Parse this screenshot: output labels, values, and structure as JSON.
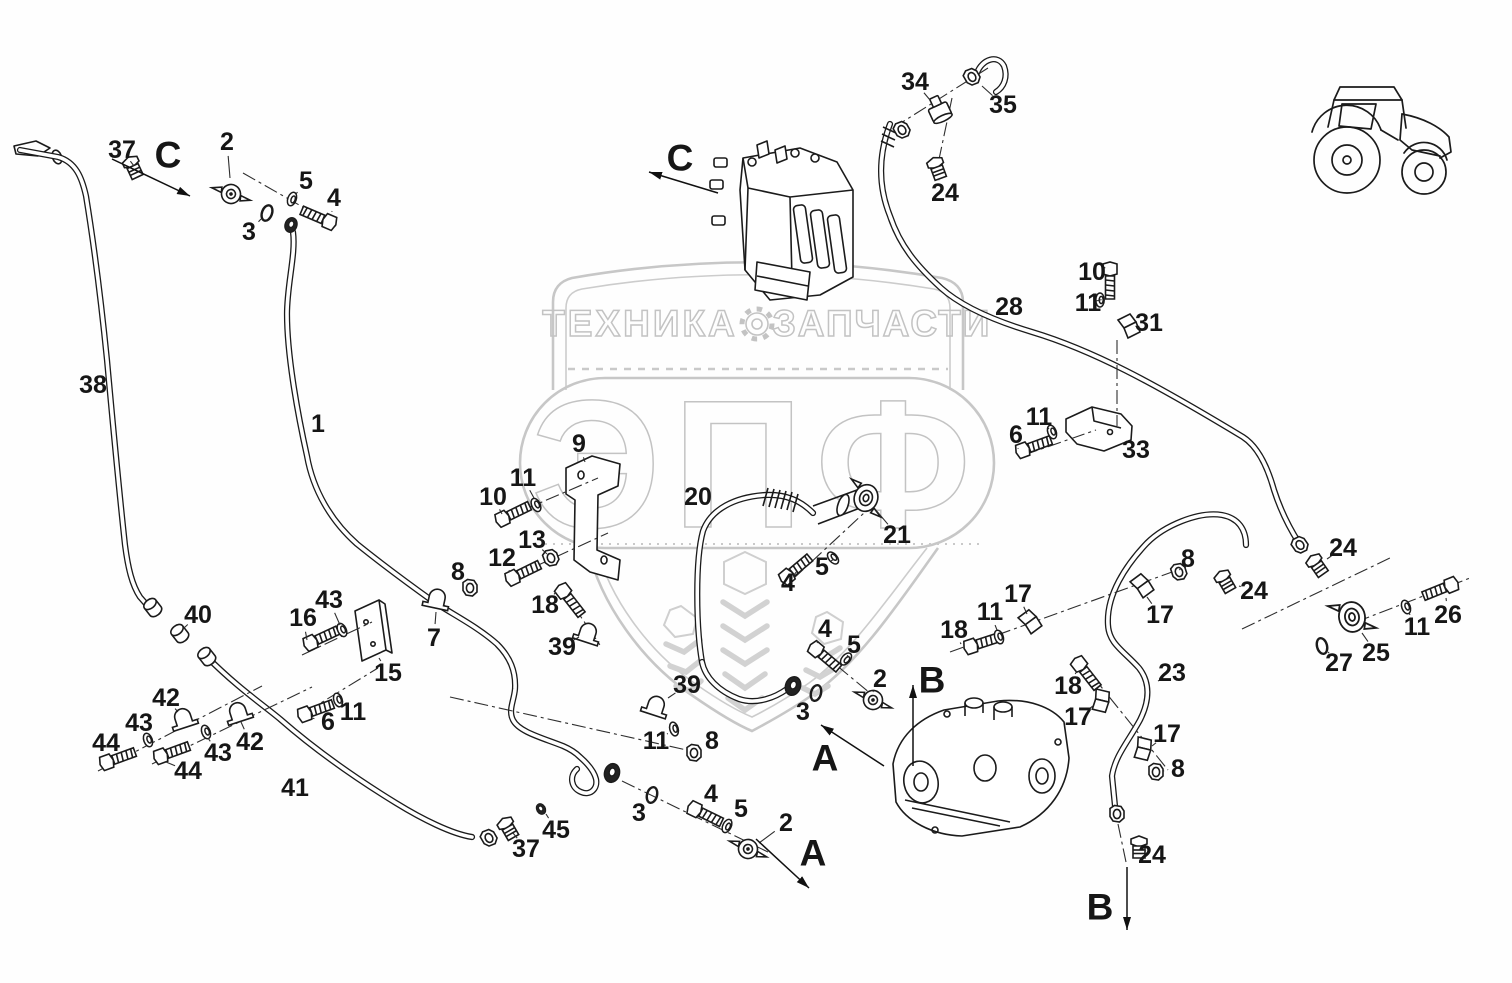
{
  "watermark": {
    "top_left": "ТЕХНИКА",
    "top_right": "ЗАПЧАСТИ",
    "big": "ЭПФ",
    "color": "#c7c7c7"
  },
  "colors": {
    "line": "#1b1b1b",
    "label": "#161616",
    "watermark": "#c7c7c7"
  },
  "callouts": [
    {
      "n": "37",
      "x": 122,
      "y": 150,
      "tx": 134,
      "ty": 166
    },
    {
      "n": "2",
      "x": 227,
      "y": 142,
      "tx": 230,
      "ty": 178
    },
    {
      "n": "5",
      "x": 306,
      "y": 181,
      "tx": 296,
      "ty": 194
    },
    {
      "n": "4",
      "x": 334,
      "y": 198,
      "tx": 332,
      "ty": 211
    },
    {
      "n": "3",
      "x": 249,
      "y": 232,
      "tx": 261,
      "ty": 219
    },
    {
      "n": "38",
      "x": 93,
      "y": 385
    },
    {
      "n": "1",
      "x": 318,
      "y": 424
    },
    {
      "n": "9",
      "x": 579,
      "y": 444,
      "tx": 585,
      "ty": 462
    },
    {
      "n": "11",
      "x": 523,
      "y": 478,
      "tx": 534,
      "ty": 498
    },
    {
      "n": "10",
      "x": 493,
      "y": 497,
      "tx": 502,
      "ty": 514
    },
    {
      "n": "13",
      "x": 532,
      "y": 540,
      "tx": 547,
      "ty": 554
    },
    {
      "n": "12",
      "x": 502,
      "y": 558,
      "tx": 510,
      "ty": 572
    },
    {
      "n": "8",
      "x": 458,
      "y": 572,
      "tx": 467,
      "ty": 583
    },
    {
      "n": "43",
      "x": 329,
      "y": 600,
      "tx": 340,
      "ty": 625
    },
    {
      "n": "16",
      "x": 303,
      "y": 618,
      "tx": 307,
      "ty": 640
    },
    {
      "n": "7",
      "x": 434,
      "y": 638,
      "tx": 436,
      "ty": 612
    },
    {
      "n": "15",
      "x": 388,
      "y": 673,
      "tx": 379,
      "ty": 658
    },
    {
      "n": "18",
      "x": 545,
      "y": 605,
      "tx": 556,
      "ty": 592
    },
    {
      "n": "39",
      "x": 562,
      "y": 647,
      "tx": 579,
      "ty": 637
    },
    {
      "n": "6",
      "x": 328,
      "y": 722,
      "tx": 312,
      "ty": 718
    },
    {
      "n": "11",
      "x": 353,
      "y": 712,
      "tx": 341,
      "ty": 703
    },
    {
      "n": "40",
      "x": 198,
      "y": 615,
      "tx": 184,
      "ty": 628
    },
    {
      "n": "42",
      "x": 166,
      "y": 698,
      "tx": 178,
      "ty": 712
    },
    {
      "n": "43",
      "x": 139,
      "y": 723,
      "tx": 146,
      "ty": 735
    },
    {
      "n": "44",
      "x": 106,
      "y": 743,
      "tx": 106,
      "ty": 757
    },
    {
      "n": "43",
      "x": 218,
      "y": 753,
      "tx": 208,
      "ty": 738
    },
    {
      "n": "44",
      "x": 188,
      "y": 771,
      "tx": 166,
      "ty": 762
    },
    {
      "n": "42",
      "x": 250,
      "y": 742,
      "tx": 241,
      "ty": 722
    },
    {
      "n": "41",
      "x": 295,
      "y": 788
    },
    {
      "n": "39",
      "x": 687,
      "y": 685,
      "tx": 668,
      "ty": 698
    },
    {
      "n": "11",
      "x": 656,
      "y": 741,
      "tx": 667,
      "ty": 734
    },
    {
      "n": "8",
      "x": 712,
      "y": 741,
      "tx": 701,
      "ty": 748
    },
    {
      "n": "3",
      "x": 639,
      "y": 813,
      "tx": 648,
      "ty": 801
    },
    {
      "n": "45",
      "x": 556,
      "y": 830,
      "tx": 546,
      "ty": 814
    },
    {
      "n": "37",
      "x": 526,
      "y": 849,
      "tx": 513,
      "ty": 833
    },
    {
      "n": "4",
      "x": 711,
      "y": 794,
      "tx": 700,
      "ty": 804
    },
    {
      "n": "5",
      "x": 741,
      "y": 809,
      "tx": 731,
      "ty": 820
    },
    {
      "n": "2",
      "x": 786,
      "y": 823,
      "tx": 759,
      "ty": 843
    },
    {
      "n": "3",
      "x": 803,
      "y": 712,
      "tx": 813,
      "ty": 699
    },
    {
      "n": "20",
      "x": 698,
      "y": 497
    },
    {
      "n": "21",
      "x": 897,
      "y": 535,
      "tx": 875,
      "ty": 509
    },
    {
      "n": "5",
      "x": 822,
      "y": 567,
      "tx": 831,
      "ty": 561
    },
    {
      "n": "4",
      "x": 788,
      "y": 583,
      "tx": 794,
      "ty": 575
    },
    {
      "n": "4",
      "x": 825,
      "y": 629,
      "tx": 817,
      "ty": 643
    },
    {
      "n": "5",
      "x": 854,
      "y": 645,
      "tx": 848,
      "ty": 655
    },
    {
      "n": "2",
      "x": 880,
      "y": 679,
      "tx": 873,
      "ty": 692
    },
    {
      "n": "18",
      "x": 954,
      "y": 630,
      "tx": 961,
      "ty": 644
    },
    {
      "n": "11",
      "x": 990,
      "y": 612,
      "tx": 997,
      "ty": 630
    },
    {
      "n": "17",
      "x": 1018,
      "y": 594,
      "tx": 1027,
      "ty": 614
    },
    {
      "n": "8",
      "x": 1188,
      "y": 559,
      "tx": 1181,
      "ty": 568
    },
    {
      "n": "17",
      "x": 1160,
      "y": 615,
      "tx": 1147,
      "ty": 597
    },
    {
      "n": "24",
      "x": 1254,
      "y": 591,
      "tx": 1239,
      "ty": 586
    },
    {
      "n": "23",
      "x": 1172,
      "y": 673,
      "tx": 1158,
      "ty": 681
    },
    {
      "n": "18",
      "x": 1068,
      "y": 686,
      "tx": 1077,
      "ty": 671
    },
    {
      "n": "17",
      "x": 1078,
      "y": 717,
      "tx": 1093,
      "ty": 706
    },
    {
      "n": "17",
      "x": 1167,
      "y": 734,
      "tx": 1152,
      "ty": 746
    },
    {
      "n": "8",
      "x": 1178,
      "y": 769,
      "tx": 1163,
      "ty": 771
    },
    {
      "n": "24",
      "x": 1343,
      "y": 548,
      "tx": 1327,
      "ty": 559
    },
    {
      "n": "27",
      "x": 1339,
      "y": 663,
      "tx": 1328,
      "ty": 652
    },
    {
      "n": "25",
      "x": 1376,
      "y": 653,
      "tx": 1362,
      "ty": 633
    },
    {
      "n": "11",
      "x": 1417,
      "y": 627,
      "tx": 1409,
      "ty": 613
    },
    {
      "n": "26",
      "x": 1448,
      "y": 615,
      "tx": 1446,
      "ty": 598
    },
    {
      "n": "28",
      "x": 1009,
      "y": 307
    },
    {
      "n": "10",
      "x": 1092,
      "y": 272,
      "tx": 1104,
      "ty": 268
    },
    {
      "n": "11",
      "x": 1088,
      "y": 303,
      "tx": 1096,
      "ty": 301
    },
    {
      "n": "31",
      "x": 1149,
      "y": 323,
      "tx": 1137,
      "ty": 326
    },
    {
      "n": "11",
      "x": 1039,
      "y": 417,
      "tx": 1049,
      "ty": 429
    },
    {
      "n": "6",
      "x": 1016,
      "y": 435,
      "tx": 1018,
      "ty": 448
    },
    {
      "n": "33",
      "x": 1136,
      "y": 450,
      "tx": 1122,
      "ty": 443
    },
    {
      "n": "34",
      "x": 915,
      "y": 82,
      "tx": 930,
      "ty": 100
    },
    {
      "n": "35",
      "x": 1003,
      "y": 105,
      "tx": 982,
      "ty": 86
    },
    {
      "n": "24",
      "x": 945,
      "y": 193,
      "tx": 939,
      "ty": 180
    },
    {
      "n": "24",
      "x": 1152,
      "y": 855,
      "tx": 1146,
      "ty": 851
    }
  ],
  "sections": [
    {
      "n": "C",
      "x": 168,
      "y": 155,
      "a": [
        112,
        159,
        190,
        196
      ]
    },
    {
      "n": "C",
      "x": 680,
      "y": 158,
      "a": [
        718,
        193,
        649,
        172
      ]
    },
    {
      "n": "A",
      "x": 825,
      "y": 758,
      "a": [
        884,
        766,
        821,
        725
      ]
    },
    {
      "n": "A",
      "x": 813,
      "y": 853,
      "a": [
        756,
        839,
        809,
        888
      ]
    },
    {
      "n": "B",
      "x": 932,
      "y": 680,
      "a": [
        913,
        766,
        913,
        685
      ]
    },
    {
      "n": "B",
      "x": 1100,
      "y": 907,
      "a": [
        1127,
        867,
        1127,
        930
      ]
    }
  ],
  "axes": [
    [
      302,
      655,
      372,
      622
    ],
    [
      306,
      712,
      378,
      668
    ],
    [
      98,
      771,
      262,
      686
    ],
    [
      152,
      764,
      312,
      687
    ],
    [
      500,
      520,
      598,
      478
    ],
    [
      510,
      578,
      608,
      533
    ],
    [
      560,
      586,
      600,
      645
    ],
    [
      893,
      128,
      988,
      68
    ],
    [
      952,
      98,
      938,
      164
    ],
    [
      1117,
      340,
      1117,
      426
    ],
    [
      950,
      652,
      1186,
      567
    ],
    [
      1078,
      658,
      1168,
      770
    ],
    [
      1024,
      455,
      1096,
      430
    ],
    [
      1242,
      629,
      1392,
      557
    ],
    [
      1356,
      622,
      1470,
      578
    ],
    [
      622,
      781,
      768,
      852
    ],
    [
      793,
      579,
      864,
      513
    ],
    [
      818,
      650,
      876,
      698
    ],
    [
      243,
      173,
      336,
      226
    ],
    [
      450,
      697,
      700,
      753
    ],
    [
      1118,
      824,
      1126,
      862
    ]
  ],
  "parts": [
    {
      "k": "flange",
      "x": 231,
      "y": 194,
      "r": -15
    },
    {
      "k": "oring",
      "x": 267,
      "y": 213,
      "r": 20
    },
    {
      "k": "washer",
      "x": 292,
      "y": 199,
      "r": 20
    },
    {
      "k": "bolt",
      "x": 334,
      "y": 224,
      "r": 203
    },
    {
      "k": "darknut",
      "x": 291,
      "y": 225,
      "r": 20,
      "s": 0.8
    },
    {
      "k": "fitting",
      "x": 133,
      "y": 167,
      "r": -25
    },
    {
      "k": "bushing",
      "x": 150,
      "y": 604,
      "r": -38
    },
    {
      "k": "bushing",
      "x": 177,
      "y": 630,
      "r": -38
    },
    {
      "k": "bushing",
      "x": 204,
      "y": 653,
      "r": -38
    },
    {
      "k": "clamp",
      "x": 182,
      "y": 718,
      "r": -18
    },
    {
      "k": "clamp",
      "x": 237,
      "y": 712,
      "r": -18
    },
    {
      "k": "washer",
      "x": 148,
      "y": 740,
      "r": -20
    },
    {
      "k": "washer",
      "x": 206,
      "y": 732,
      "r": -20
    },
    {
      "k": "bolt",
      "x": 102,
      "y": 764,
      "r": -20
    },
    {
      "k": "bolt",
      "x": 156,
      "y": 758,
      "r": -20
    },
    {
      "k": "bolt",
      "x": 306,
      "y": 645,
      "r": -25
    },
    {
      "k": "washer",
      "x": 342,
      "y": 630,
      "r": -25
    },
    {
      "k": "bolt",
      "x": 300,
      "y": 716,
      "r": -20
    },
    {
      "k": "washer",
      "x": 338,
      "y": 700,
      "r": -18
    },
    {
      "k": "clamp",
      "x": 436,
      "y": 598,
      "r": 12
    },
    {
      "k": "nut",
      "x": 470,
      "y": 588,
      "r": 0
    },
    {
      "k": "bolt",
      "x": 498,
      "y": 521,
      "r": -26
    },
    {
      "k": "washer",
      "x": 536,
      "y": 505,
      "r": -26
    },
    {
      "k": "bolt",
      "x": 508,
      "y": 580,
      "r": -26
    },
    {
      "k": "nut",
      "x": 551,
      "y": 558,
      "r": -20
    },
    {
      "k": "bolt",
      "x": 560,
      "y": 587,
      "r": 52
    },
    {
      "k": "clamp",
      "x": 587,
      "y": 632,
      "r": 18
    },
    {
      "k": "clamp",
      "x": 655,
      "y": 705,
      "r": 18
    },
    {
      "k": "washer",
      "x": 674,
      "y": 729,
      "r": -15
    },
    {
      "k": "nut",
      "x": 694,
      "y": 753,
      "r": 0
    },
    {
      "k": "darknut",
      "x": 612,
      "y": 773,
      "r": 15
    },
    {
      "k": "oring",
      "x": 652,
      "y": 795,
      "r": 15
    },
    {
      "k": "bolt",
      "x": 690,
      "y": 807,
      "r": 26
    },
    {
      "k": "washer",
      "x": 727,
      "y": 826,
      "r": 26
    },
    {
      "k": "flange",
      "x": 748,
      "y": 849,
      "r": -10
    },
    {
      "k": "nut",
      "x": 489,
      "y": 838,
      "r": -30
    },
    {
      "k": "fitting",
      "x": 508,
      "y": 828,
      "r": -30
    },
    {
      "k": "darknut",
      "x": 541,
      "y": 809,
      "r": -30,
      "s": 0.6
    },
    {
      "k": "darknut",
      "x": 793,
      "y": 686,
      "r": 20
    },
    {
      "k": "oring",
      "x": 816,
      "y": 693,
      "r": 15
    },
    {
      "k": "bolt",
      "x": 812,
      "y": 646,
      "r": 40
    },
    {
      "k": "washer",
      "x": 846,
      "y": 659,
      "r": 40
    },
    {
      "k": "flange",
      "x": 873,
      "y": 700,
      "r": -10
    },
    {
      "k": "bolt",
      "x": 783,
      "y": 580,
      "r": -40
    },
    {
      "k": "washer",
      "x": 833,
      "y": 558,
      "r": -40
    },
    {
      "k": "flangebig",
      "x": 866,
      "y": 498,
      "r": 18,
      "s": 0.9
    },
    {
      "k": "tee",
      "x": 940,
      "y": 112,
      "r": -25
    },
    {
      "k": "nut",
      "x": 972,
      "y": 77,
      "r": -30
    },
    {
      "k": "nut",
      "x": 902,
      "y": 130,
      "r": -30
    },
    {
      "k": "fitting",
      "x": 937,
      "y": 168,
      "r": -20
    },
    {
      "k": "bolt",
      "x": 1110,
      "y": 264,
      "r": 90
    },
    {
      "k": "washer",
      "x": 1100,
      "y": 300,
      "r": 0
    },
    {
      "k": "clip",
      "x": 1128,
      "y": 326,
      "r": 0
    },
    {
      "k": "bolt",
      "x": 1018,
      "y": 452,
      "r": -20
    },
    {
      "k": "washer",
      "x": 1052,
      "y": 432,
      "r": -20
    },
    {
      "k": "bolt",
      "x": 966,
      "y": 648,
      "r": -18
    },
    {
      "k": "washer",
      "x": 999,
      "y": 637,
      "r": -18
    },
    {
      "k": "clip",
      "x": 1029,
      "y": 622,
      "r": -10
    },
    {
      "k": "clip",
      "x": 1141,
      "y": 586,
      "r": -10
    },
    {
      "k": "nut",
      "x": 1179,
      "y": 572,
      "r": -18
    },
    {
      "k": "bolt",
      "x": 1076,
      "y": 660,
      "r": 52
    },
    {
      "k": "clip",
      "x": 1100,
      "y": 700,
      "r": 40
    },
    {
      "k": "clip",
      "x": 1142,
      "y": 748,
      "r": 40
    },
    {
      "k": "nut",
      "x": 1156,
      "y": 772,
      "r": 0
    },
    {
      "k": "nut",
      "x": 1117,
      "y": 814,
      "r": 0
    },
    {
      "k": "fitting",
      "x": 1139,
      "y": 847,
      "r": 0
    },
    {
      "k": "fitting",
      "x": 1225,
      "y": 581,
      "r": -30
    },
    {
      "k": "nut",
      "x": 1300,
      "y": 545,
      "r": -35
    },
    {
      "k": "fitting",
      "x": 1317,
      "y": 565,
      "r": -35
    },
    {
      "k": "flangebig",
      "x": 1352,
      "y": 617,
      "r": -10
    },
    {
      "k": "oring",
      "x": 1322,
      "y": 646,
      "r": -15
    },
    {
      "k": "washer",
      "x": 1406,
      "y": 607,
      "r": -20
    },
    {
      "k": "bolt",
      "x": 1456,
      "y": 583,
      "r": 158
    }
  ]
}
